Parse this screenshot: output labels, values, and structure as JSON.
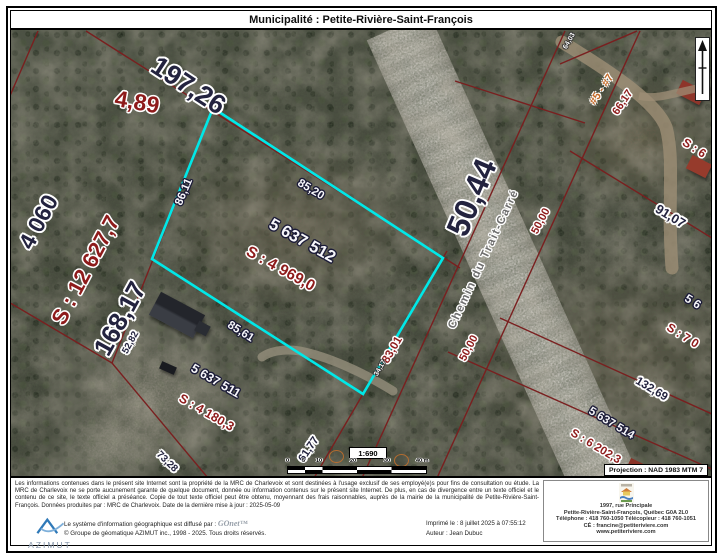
{
  "title": "Municipalité : Petite-Rivière-Saint-François",
  "colors": {
    "highlight_cyan": "#00e8e8",
    "cadastral_red": "#7a1f1f",
    "navy_label": "#23233f",
    "red_label": "#8e1b1b"
  },
  "map": {
    "road_name": "Chemin du Trait-Carré",
    "projection": "Projection : NAD 1983 MTM 7",
    "scale": {
      "ratio": "1:690",
      "ticks": [
        "0",
        "5",
        "10",
        "20",
        "30",
        "40 m"
      ]
    },
    "labels": {
      "len_197_26": "197,26",
      "len_4_89": "4,89",
      "lot_4060": "4 060",
      "area_12627": "S : 12 627,7",
      "len_168_17": "168,17",
      "len_52_82": "52,82",
      "len_50_44": "50,44",
      "len_65": "65",
      "address_range": "#5 - #7",
      "len_66_17": "66,17",
      "len_50_00_a": "50,00",
      "len_50_00_b": "50,00",
      "len_91_07": "91,07",
      "len_132_69": "132,69",
      "lot_5637514": "5 637 514",
      "area_6202": "S : 6 202,3",
      "area_7_partial": "S : 7 0",
      "lot_56_partial": "5 6",
      "area_s6_partial": "S : 6",
      "lot_5637512": "5 637 512",
      "area_4969": "S : 4 969,0",
      "len_86_11": "86,11",
      "len_85_20": "85,20",
      "len_85_61": "85,61",
      "len_83_01": "83,01",
      "lot_5637511": "5 637 511",
      "area_4180": "S : 4 180,3",
      "len_73_28": "73,28",
      "len_61_77": "61,77",
      "len_34_17": "34,17",
      "len_64_03": "64,03"
    }
  },
  "footer": {
    "legal": "Les informations contenues dans le présent site Internet sont la propriété de la MRC de Charlevoix et sont destinées à l'usage exclusif de ses employé(e)s pour fins de consultation ou étude. La MRC de Charlevoix ne se porte aucunement garante de quelque document, donnée ou information contenus sur le présent site Internet. De plus, en cas de divergence entre un texte officiel et le contenu de ce site, le texte officiel a préséance. Copie de tout texte officiel peut être obtenu, moyennant des frais raisonnables, auprès de la mairie de la municipalité de Petite-Rivière-Saint-François. Données produites par : MRC de Charlevoix. Date de la dernière mise à jour : 2025-05-09",
    "contact": {
      "address_line1": "1997, rue Principale",
      "address_line2": "Petite-Rivière-Saint-François, Québec G0A 2L0",
      "phone_line": "Téléphone : 418 760-1050  Télécopieur : 418 760-1051",
      "email_line": "CÉ : francine@petiteriviere.com",
      "website": "www.petiteriviere.com"
    },
    "credits": {
      "azimut_logo_text": "AZIMUT",
      "diffusion_prefix": "Le système d'information géographique est diffusé par :",
      "gonet": "GOnet™",
      "copyright": "© Groupe de géomatique AZIMUT inc., 1998 - 2025. Tous droits réservés.",
      "printed": "Imprimé le : 8 juillet 2025 à 07:55:12",
      "author": "Auteur : Jean Dubuc"
    }
  }
}
